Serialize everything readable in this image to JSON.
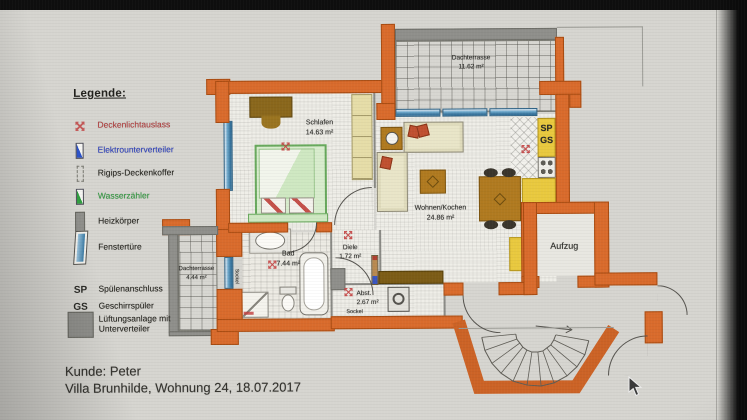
{
  "legend": {
    "title": "Legende:",
    "items": [
      {
        "icon": "ceiling-light-outlet",
        "label": "Deckenlichtauslass",
        "color": "#b73c3c"
      },
      {
        "icon": "electrical-subpanel",
        "label": "Elektrounterverteiler",
        "color": "#2b3fc4"
      },
      {
        "icon": "drywall-ceiling-box",
        "label": "Rigips-Deckenkoffer",
        "color": "#26251f"
      },
      {
        "icon": "water-meter",
        "label": "Wasserzähler",
        "color": "#2f9e3f"
      },
      {
        "icon": "radiator",
        "label": "Heizkörper",
        "color": "#26251f"
      },
      {
        "icon": "window-door",
        "label": "Fenstertüre",
        "color": "#26251f"
      },
      {
        "icon": "sp-abbrev",
        "abbrev": "SP",
        "label": "Spülenanschluss",
        "color": "#26251f"
      },
      {
        "icon": "gs-abbrev",
        "abbrev": "GS",
        "label": "Geschirrspüler",
        "color": "#26251f"
      },
      {
        "icon": "ventilation-unit",
        "label": "Lüftungsanlage mit Unterverteiler",
        "lines": [
          "Lüftungsanlage mit",
          "Unterverteiler"
        ],
        "color": "#26251f"
      }
    ]
  },
  "rooms": {
    "schlafen": {
      "name": "Schlafen",
      "area": "14.63 m²"
    },
    "dachterrasse_top": {
      "name": "Dachterrasse",
      "area": "11.62 m²"
    },
    "wohnen_kochen": {
      "name": "Wohnen/Kochen",
      "area": "24.86 m²"
    },
    "bad": {
      "name": "Bad",
      "area": "7.44 m²"
    },
    "diele": {
      "name": "Diele",
      "area": "1.72 m²"
    },
    "abstellraum": {
      "name": "Abst.",
      "area": "2.67 m²"
    },
    "dachterrasse_left": {
      "name": "Dachterrasse",
      "area": "4.44 m²"
    },
    "aufzug": {
      "name": "Aufzug"
    }
  },
  "plan_labels": {
    "sp": "SP",
    "gs": "GS",
    "sockel_left": "Sockel",
    "sockel_bottom": "Sockel"
  },
  "footer": {
    "line1": "Kunde: Peter",
    "line2": "Villa Brunhilde, Wohnung 24, 18.07.2017"
  },
  "colors": {
    "wall_orange": "#d96b2c",
    "wall_gray": "#8f8f8b",
    "window_blue": "#3c7ba3",
    "symbol_red": "#c23b3b",
    "kitchen_yellow": "#e9c93f",
    "bed_green": "#67a85c"
  }
}
